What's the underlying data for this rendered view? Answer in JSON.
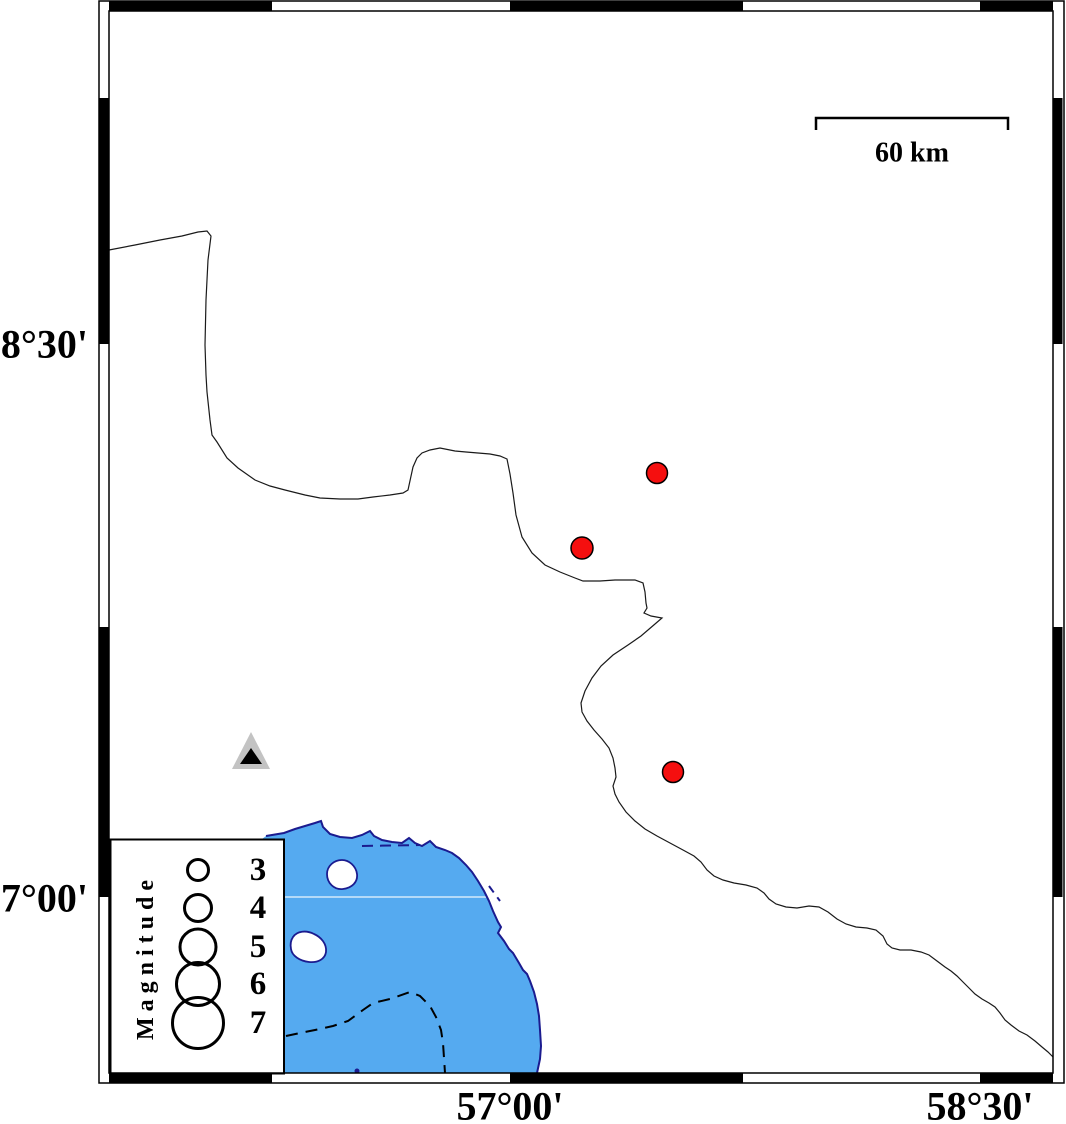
{
  "figure": {
    "axis": {
      "lat_labels": [
        {
          "text": "28°30'",
          "y": 344
        },
        {
          "text": "27°00'",
          "y": 898
        }
      ],
      "lon_labels": [
        {
          "text": "57°00'",
          "x": 510
        },
        {
          "text": "58°30'",
          "x": 980
        }
      ]
    },
    "scale_bar": {
      "label": "60 km"
    },
    "legend": {
      "title": "Magnitude",
      "circle_cx": 198,
      "label_x": 258,
      "entries": [
        {
          "label": "3",
          "cy": 870,
          "r": 10.5
        },
        {
          "label": "4",
          "cy": 908,
          "r": 13.5
        },
        {
          "label": "5",
          "cy": 947,
          "r": 18
        },
        {
          "label": "6",
          "cy": 984,
          "r": 21.5
        },
        {
          "label": "7",
          "cy": 1023,
          "r": 25.5
        }
      ]
    },
    "markers": {
      "earthquakes": [
        {
          "x": 657,
          "y": 473,
          "r": 10.5
        },
        {
          "x": 582,
          "y": 548,
          "r": 11
        },
        {
          "x": 673,
          "y": 772,
          "r": 10.5
        }
      ],
      "station": {
        "x": 251,
        "y": 750
      }
    },
    "colors": {
      "sea": "#55aaf0",
      "coast": "#1b1b8f",
      "earthquake": "#f50f0f",
      "station_gray": "#c3c3c3"
    }
  }
}
